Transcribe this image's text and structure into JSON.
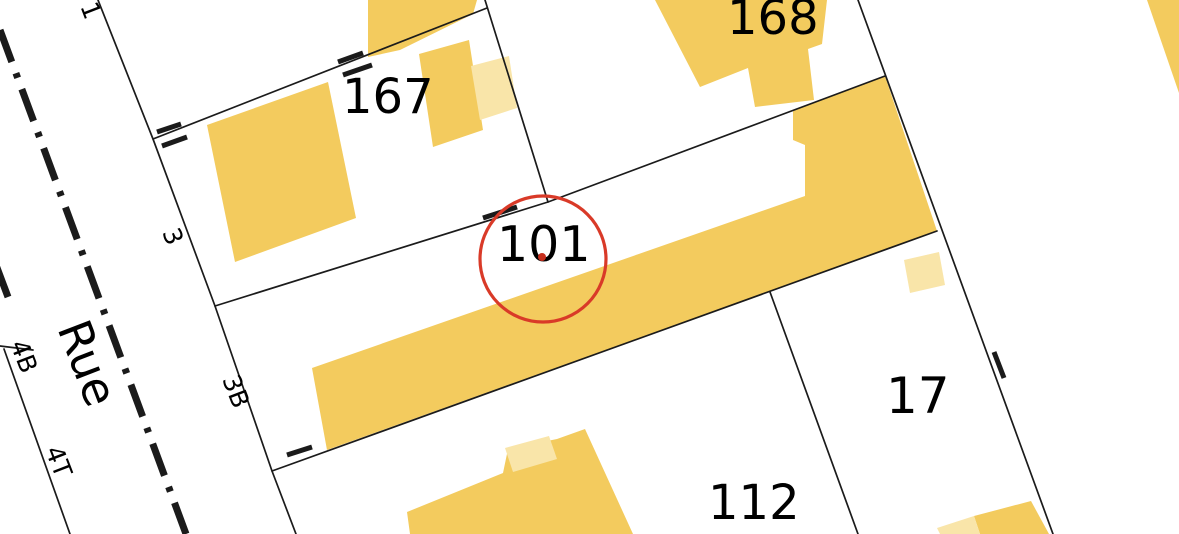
{
  "map": {
    "street_name": "Rue",
    "parcel_numbers": {
      "p167": "167",
      "p168": "168",
      "p101": "101",
      "p17": "17",
      "p112": "112"
    },
    "address_numbers": {
      "n1": "1",
      "n3": "3",
      "n3b": "3B",
      "n4b": "4B",
      "n4t": "4T"
    },
    "highlight": {
      "parcel": "101",
      "circle_color": "#d93a28",
      "dot_color": "#c62f1d"
    },
    "colors": {
      "building": "#f3cb5e",
      "building_light": "#f9e5a9",
      "line": "#1b1b1b",
      "background": "#ffffff"
    }
  }
}
